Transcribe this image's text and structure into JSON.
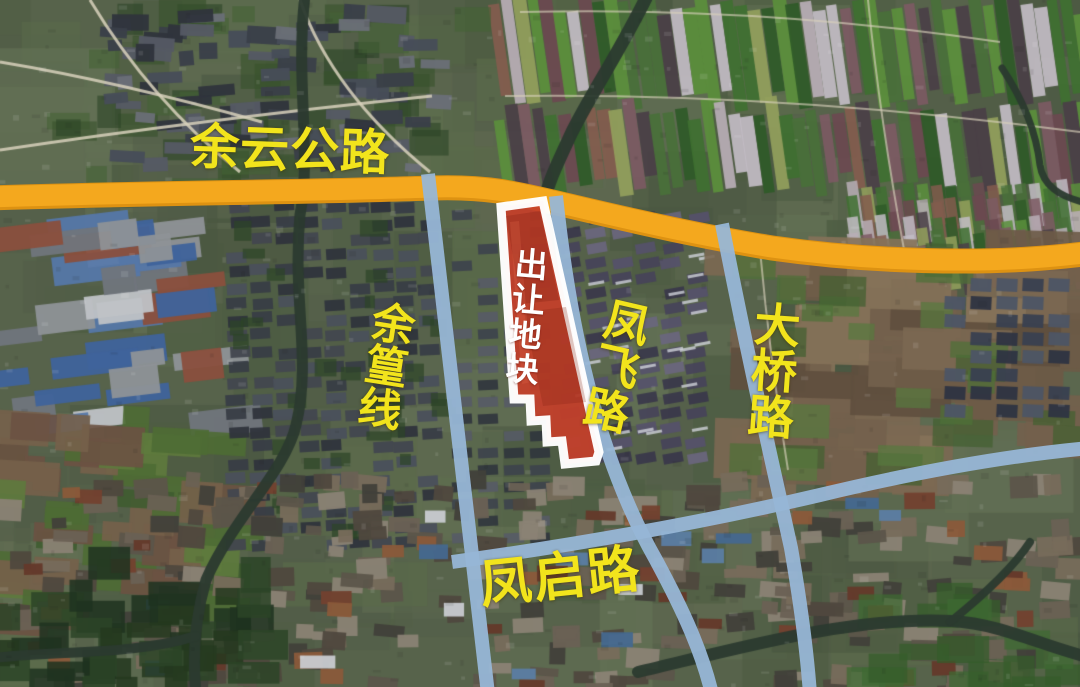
{
  "map": {
    "type": "satellite-annotation-map",
    "parcel": {
      "label": "出让地块"
    },
    "roads": [
      {
        "id": "yuyun",
        "label": "余云公路",
        "style": "highway-orange",
        "orientation": "horizontal-top"
      },
      {
        "id": "yuhuang",
        "label": "余篁线",
        "style": "road-blue",
        "orientation": "vertical-left"
      },
      {
        "id": "fengfei",
        "label": "凤飞路",
        "style": "road-blue",
        "orientation": "vertical-middle"
      },
      {
        "id": "daqiao",
        "label": "大桥路",
        "style": "road-blue",
        "orientation": "vertical-right"
      },
      {
        "id": "fengqi",
        "label": "凤启路",
        "style": "road-blue",
        "orientation": "horizontal-bottom"
      }
    ],
    "colors": {
      "highway": "#F4A81E",
      "highway_edge": "#DD9212",
      "road": "#97B6D6",
      "parcel_fill": "#C5402A",
      "parcel_outline": "#FFFFFF",
      "road_label": "#F2E41C",
      "parcel_label": "#FFFFFF"
    }
  }
}
